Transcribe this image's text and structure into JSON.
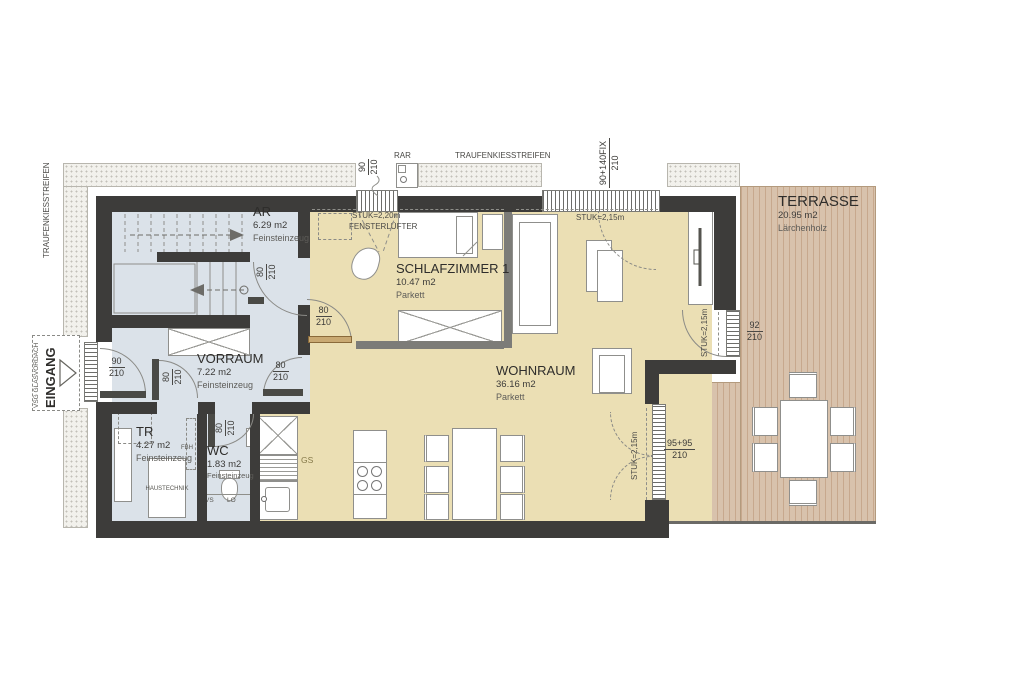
{
  "colors": {
    "wall": "#3d3c3a",
    "parkett": "#ebdfb4",
    "tile": "#dbe2e9",
    "terrace": "#d8c2ac",
    "terrace_stripe": "#c7a88d",
    "gravel_bg": "#f2f1ec",
    "gravel_dot": "#c2c0b8",
    "furniture_border": "#8f8f8c",
    "line": "#8a8a86",
    "text": "#333230",
    "wood_door": "#c9a972",
    "gs_text": "#857949"
  },
  "rooms": {
    "ar": {
      "name": "AR",
      "area": "6.29 m2",
      "floor": "Feinsteinzeug"
    },
    "schlafzimmer1": {
      "name": "SCHLAFZIMMER 1",
      "area": "10.47 m2",
      "floor": "Parkett"
    },
    "vorraum": {
      "name": "VORRAUM",
      "area": "7.22 m2",
      "floor": "Feinsteinzeug"
    },
    "wohnraum": {
      "name": "WOHNRAUM",
      "area": "36.16 m2",
      "floor": "Parkett"
    },
    "tr": {
      "name": "TR",
      "area": "4.27 m2",
      "floor": "Feinsteinzeug"
    },
    "wc": {
      "name": "WC",
      "area": "1.83 m2",
      "floor": "Feinsteinzeug"
    },
    "terrasse": {
      "name": "TERRASSE",
      "area": "20.95 m2",
      "floor": "Lärchenholz"
    }
  },
  "annotations": {
    "traufenkiesstreifen_left": "TRAUFENKIESSTREIFEN",
    "traufenkiesstreifen_top": "TRAUFENKIESSTREIFEN",
    "rar": "RAR",
    "vsg_glasvordach": "VSG GLASVORDACH",
    "eingang": "EINGANG",
    "stuk_220": "STUK=2,20m",
    "fensterluefter": "FENSTERLÜFTER",
    "stuk_215": "STUK=2,15m",
    "haustechnik": "HAUSTECHNIK",
    "gs": "GS",
    "vs": "VS",
    "lo": "LO",
    "fbh": "FBH",
    "e_v": "E-V"
  },
  "dimensions": {
    "window_90": {
      "w": "90",
      "h": "210"
    },
    "window_90_140fix": {
      "w": "90+140FIX",
      "h": "210"
    },
    "door_92": {
      "w": "92",
      "h": "210"
    },
    "door_95_95": {
      "w": "95+95",
      "h": "210"
    },
    "door_entrance": {
      "w": "90",
      "h": "210"
    },
    "door_80": {
      "w": "80",
      "h": "210"
    }
  }
}
